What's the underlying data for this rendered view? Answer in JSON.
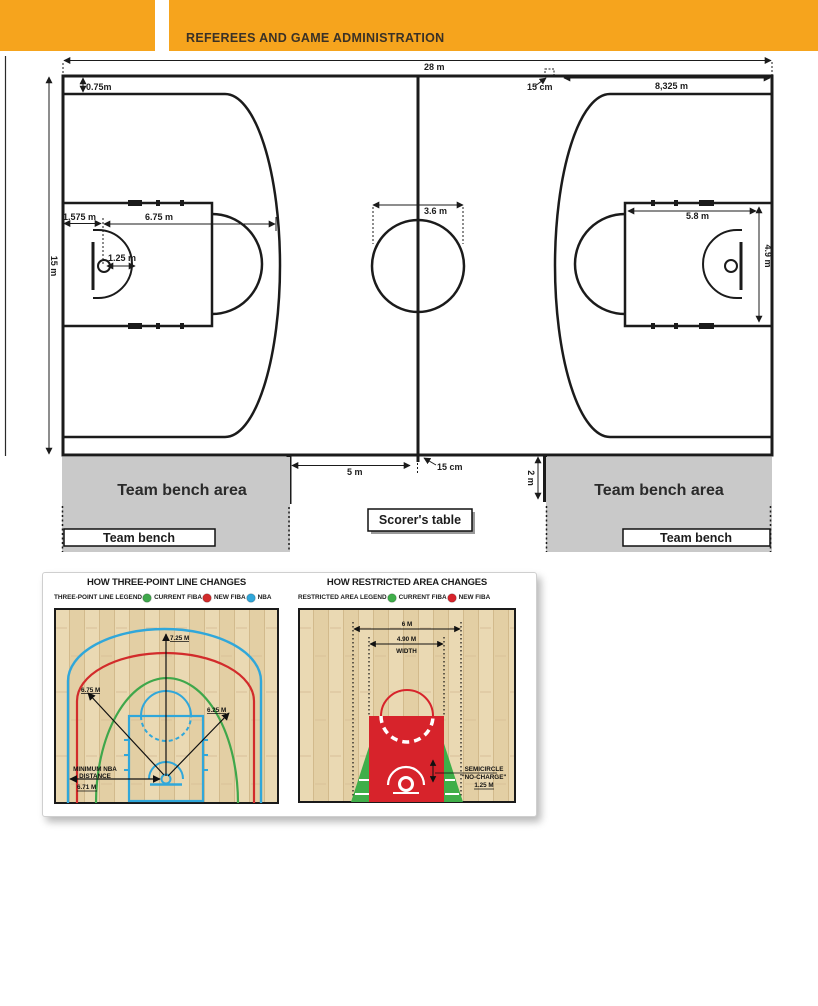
{
  "header": {
    "title": "REFEREES AND GAME ADMINISTRATION",
    "accent_color": "#F6A41D"
  },
  "court": {
    "labels": {
      "length": "28 m",
      "width": "15 m",
      "line_offset": "0.75m",
      "throw_in_mark": "15 cm",
      "throw_in_to_baseline": "8,325 m",
      "baseline_to_hoop": "1.575 m",
      "three_point_radius": "6.75 m",
      "no_charge_radius": "1.25 m",
      "center_circle_diameter": "3.6 m",
      "key_length": "5.8 m",
      "key_width": "4.9 m",
      "bench_to_center": "5 m",
      "center_line_extension": "15 cm",
      "bench_line_length": "2 m"
    },
    "bench": {
      "area_left": "Team bench area",
      "area_right": "Team bench area",
      "bench_left": "Team bench",
      "bench_right": "Team bench",
      "scorers_table": "Scorer's table"
    }
  },
  "figures": {
    "three_point": {
      "title": "HOW THREE-POINT LINE CHANGES",
      "legend_label": "THREE-POINT LINE LEGEND",
      "legend": [
        {
          "label": "CURRENT FIBA",
          "color": "#3fa74b"
        },
        {
          "label": "NEW FIBA",
          "color": "#d22b2b"
        },
        {
          "label": "NBA",
          "color": "#30a7da"
        }
      ],
      "annotations": {
        "nba": "7.25 M",
        "new_fiba": "6.75 M",
        "current_fiba": "6.25 M",
        "min_nba_1": "MINIMUM NBA",
        "min_nba_2": "DISTANCE",
        "min_nba_value": "6.71 M"
      }
    },
    "restricted": {
      "title": "HOW RESTRICTED AREA CHANGES",
      "legend_label": "RESTRICTED AREA LEGEND",
      "legend": [
        {
          "label": "CURRENT FIBA",
          "color": "#3fae49"
        },
        {
          "label": "NEW FIBA",
          "color": "#d7232b"
        }
      ],
      "annotations": {
        "outer_width": "6 M",
        "inner_width": "4.90 M",
        "inner_width_label": "WIDTH",
        "semicircle_1": "SEMICIRCLE",
        "semicircle_2": "\"NO-CHARGE\"",
        "semicircle_value": "1.25 M"
      }
    }
  }
}
